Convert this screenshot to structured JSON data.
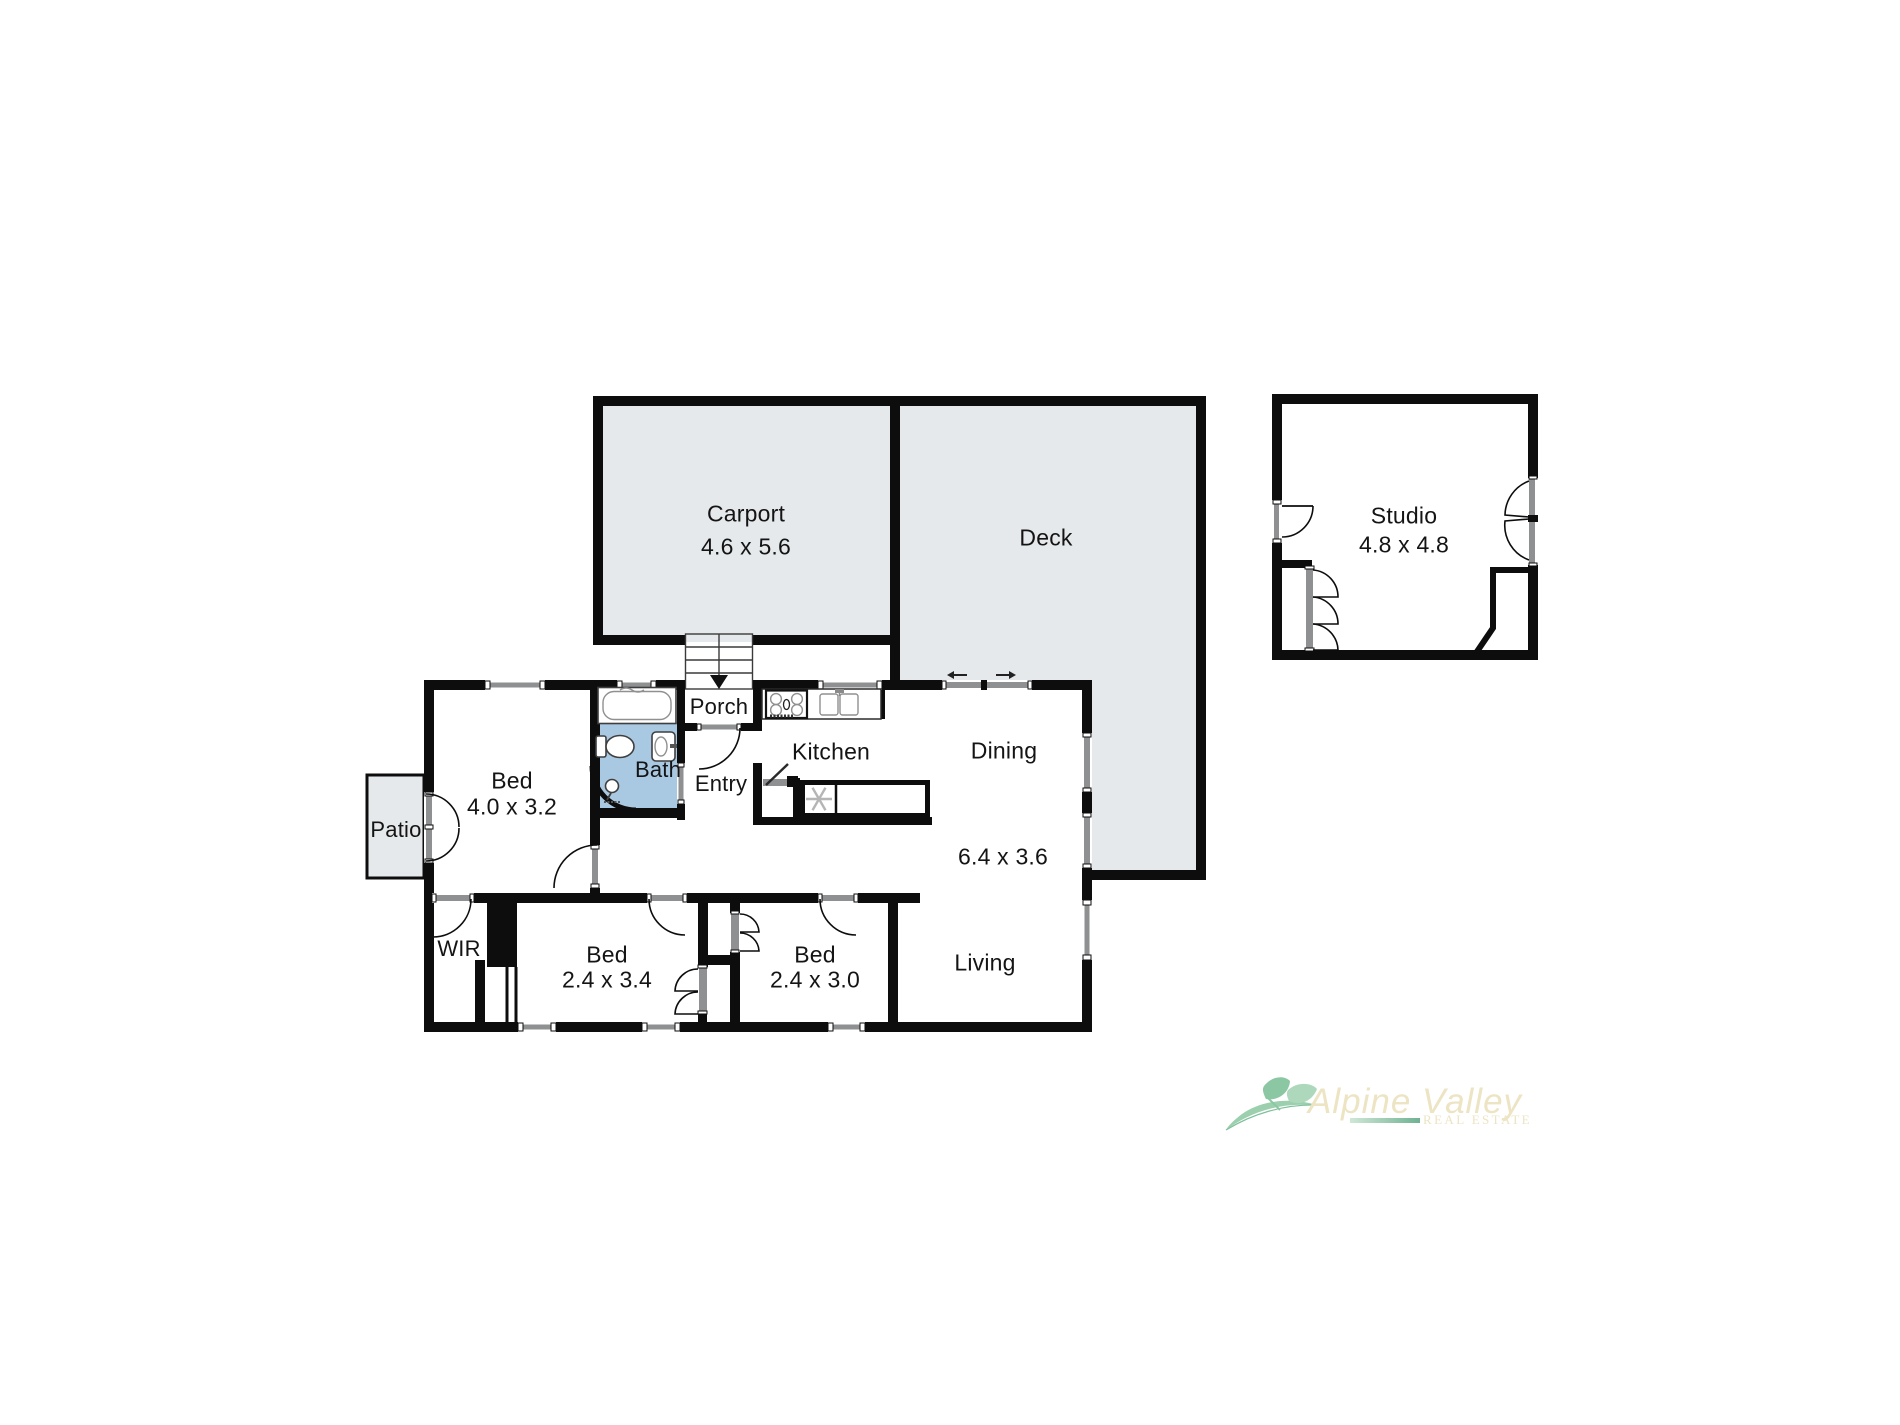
{
  "rooms": {
    "carport": {
      "name": "Carport",
      "dims": "4.6 x 5.6"
    },
    "deck": {
      "name": "Deck"
    },
    "studio": {
      "name": "Studio",
      "dims": "4.8 x 4.8"
    },
    "porch": {
      "name": "Porch"
    },
    "entry": {
      "name": "Entry"
    },
    "bath": {
      "name": "Bath"
    },
    "kitchen": {
      "name": "Kitchen"
    },
    "dining": {
      "name": "Dining"
    },
    "living": {
      "name": "Living"
    },
    "living_dining_dims": "6.4 x 3.6",
    "bed1": {
      "name": "Bed",
      "dims": "4.0 x 3.2"
    },
    "bed2": {
      "name": "Bed",
      "dims": "2.4 x 3.4"
    },
    "bed3": {
      "name": "Bed",
      "dims": "2.4 x 3.0"
    },
    "wir": {
      "name": "WIR"
    },
    "patio": {
      "name": "Patio"
    }
  },
  "branding": {
    "agency_name": "Alpine Valley",
    "tagline": "REAL ESTATE"
  },
  "icons": {
    "stairs_down_arrow": "▼",
    "slide_arrow_left": "←",
    "slide_arrow_right": "→",
    "fridge_snowflake": "✻"
  },
  "colors": {
    "wall": "#0d0d0d",
    "area_fill": "#e6e9eb",
    "bath_fill": "#a9c8e1",
    "strip": "#8e9092",
    "label": "#141414",
    "logo_green": "#9ccfad",
    "logo_green_dark": "#6fb292",
    "logo_green_light": "#cfe7d6",
    "logo_cream": "#ece4c3"
  }
}
